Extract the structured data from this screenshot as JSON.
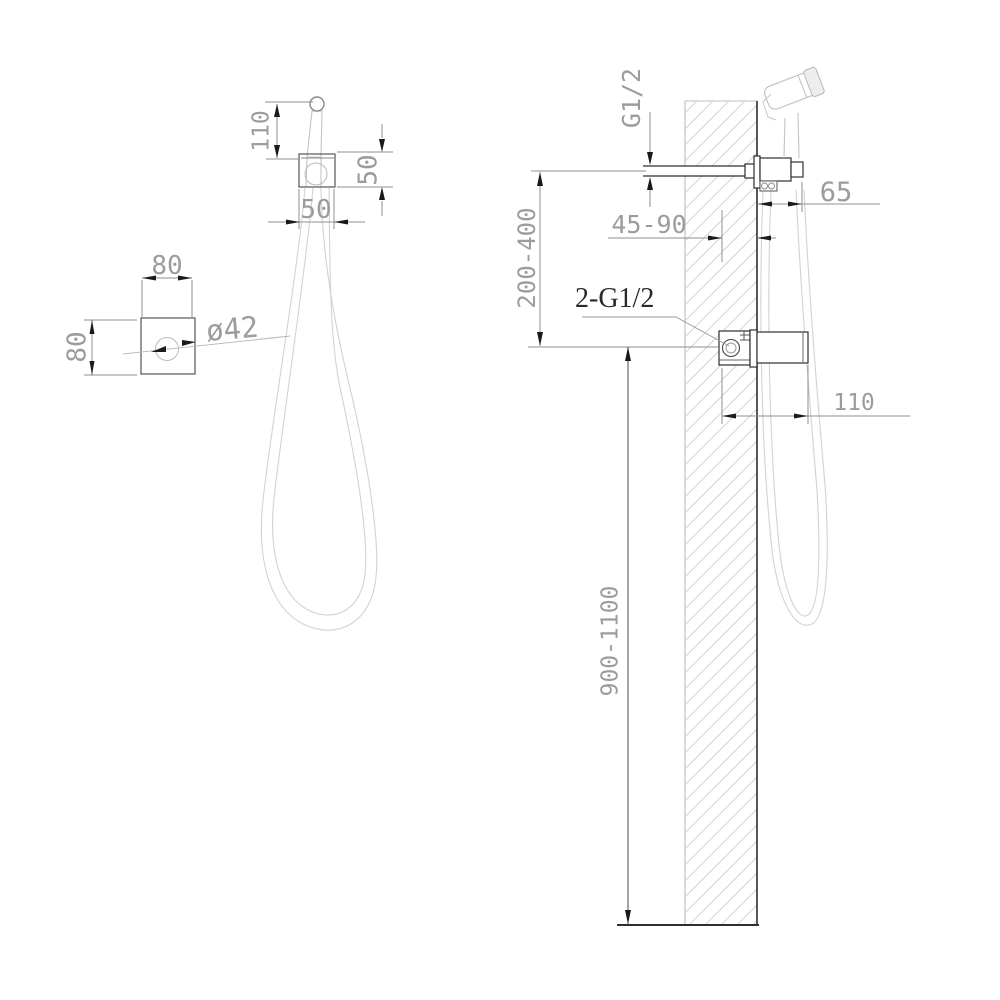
{
  "drawing": {
    "type": "technical-installation-diagram",
    "product": "wall-mounted hand shower / bidet sprayer set",
    "views": {
      "front": {
        "labels": {
          "handle_height": "110",
          "bracket_height": "50",
          "bracket_width": "50"
        }
      },
      "top": {
        "labels": {
          "width": "80",
          "depth": "80",
          "hole": "ø42"
        }
      },
      "side": {
        "labels": {
          "thread": "G1/2",
          "holder_offset": "65",
          "embed_depth": "45-90",
          "upper_height": "200-400",
          "connections": "2-G1/2",
          "valve_width": "110",
          "mount_height": "900-1100"
        }
      }
    },
    "colors": {
      "outline_dark": "#2e2e2e",
      "dim_line": "#8f8f8f",
      "dim_text": "#9c9c9c",
      "product_line": "#c4c4c4",
      "hose_line": "#d2d2d2",
      "hatch": "#c6c6c6",
      "annotation_text": "#2a2a2a"
    }
  }
}
